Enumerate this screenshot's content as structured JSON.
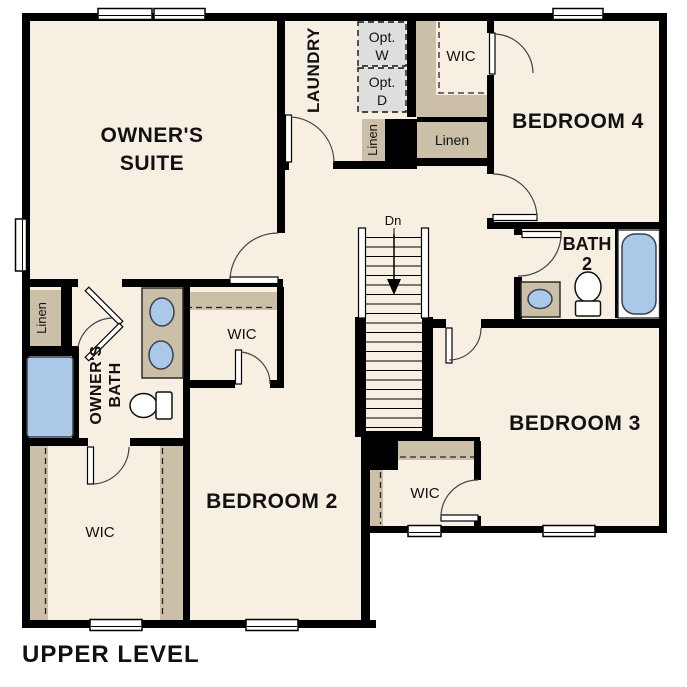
{
  "plan": {
    "level_name": "UPPER LEVEL"
  },
  "labels": {
    "owners_suite_line1": "OWNER'S",
    "owners_suite_line2": "SUITE",
    "laundry": "LAUNDRY",
    "opt_w_line1": "Opt.",
    "opt_w_line2": "W",
    "opt_d_line1": "Opt.",
    "opt_d_line2": "D",
    "linen_laundry": "Linen",
    "linen_hall": "Linen",
    "linen_owners_bath": "Linen",
    "wic_bedroom4": "WIC",
    "wic_bedroom2": "WIC",
    "wic_owners": "WIC",
    "wic_bedroom3": "WIC",
    "bedroom4": "BEDROOM 4",
    "bedroom3": "BEDROOM 3",
    "bedroom2": "BEDROOM 2",
    "bath2_line1": "BATH",
    "bath2_line2": "2",
    "owners_bath_line1": "OWNER'S",
    "owners_bath_line2": "BATH",
    "stairs_dn": "Dn",
    "plan_title": "UPPER LEVEL"
  },
  "colors": {
    "background": "#ffffff",
    "wall": "#000000",
    "floor": "#f7efe2",
    "closet": "#cbbfa8",
    "optional_appliance": "#dcdfde",
    "fixture_blue": "#aac9e9",
    "window_fill": "#ffffff",
    "door_arc": "#444444",
    "text": "#111111"
  }
}
